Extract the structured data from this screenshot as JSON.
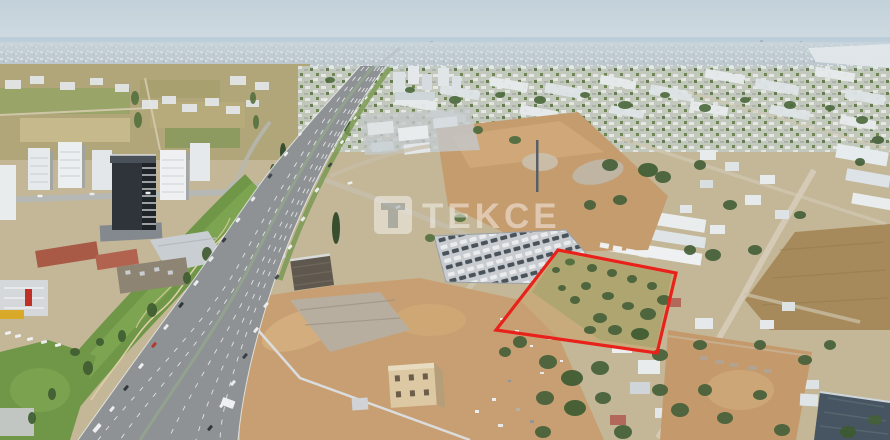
{
  "image": {
    "type": "aerial-drone-photo",
    "width": 890,
    "height": 440
  },
  "watermark": {
    "text": "TEKCE",
    "color": "#ffffff",
    "opacity": "0.45"
  },
  "plot_marker": {
    "shape": "quadrilateral",
    "points": "558,250 676,273 657,353 496,330",
    "stroke": "#e8221a",
    "stroke_width": "3.2"
  },
  "palette": {
    "sky_top": "#c2d1da",
    "sky_bottom": "#d3dce2",
    "sea": "#a9c2d3",
    "far_city": "#b6c1c7",
    "dirt": "#c59c6e",
    "dirt_light": "#d2ac7d",
    "asphalt": "#8e9294",
    "park_green": "#6f9747",
    "tree_green": "#45603a",
    "field_tan": "#b0a67a",
    "building_white": "#e9eced",
    "tower_dark": "#2e343a",
    "plot_red": "#e8221a"
  },
  "vehicles": [
    [
      97,
      428,
      10,
      4,
      "#eef0f1"
    ],
    [
      112,
      409,
      6,
      3,
      "#eceeef"
    ],
    [
      126,
      388,
      6,
      3,
      "#31373d"
    ],
    [
      141,
      366,
      6,
      3,
      "#f0f1f2"
    ],
    [
      154,
      345,
      6,
      3,
      "#b23a2c"
    ],
    [
      166,
      327,
      6,
      3,
      "#e8eaec"
    ],
    [
      181,
      305,
      6,
      3,
      "#2f353b"
    ],
    [
      196,
      283,
      6,
      3,
      "#eceeef"
    ],
    [
      211,
      259,
      6,
      3,
      "#e8eaec"
    ],
    [
      224,
      240,
      5,
      3,
      "#363c42"
    ],
    [
      238,
      220,
      5,
      3,
      "#eceeef"
    ],
    [
      253,
      199,
      5,
      3,
      "#e8eaec"
    ],
    [
      270,
      176,
      5,
      3,
      "#41474d"
    ],
    [
      286,
      154,
      5,
      2.5,
      "#eef0f1"
    ],
    [
      300,
      134,
      4,
      2.5,
      "#e8eaec"
    ],
    [
      313,
      117,
      4,
      2,
      "#d9dcde"
    ],
    [
      326,
      100,
      4,
      2,
      "#eceeef"
    ],
    [
      210,
      428,
      6,
      3,
      "#2f353b"
    ],
    [
      222,
      405,
      6,
      3,
      "#eef0f1"
    ],
    [
      233,
      383,
      6,
      3,
      "#e8eaec"
    ],
    [
      245,
      356,
      6,
      3,
      "#394047"
    ],
    [
      256,
      330,
      6,
      3,
      "#eceeef"
    ],
    [
      266,
      305,
      6,
      3,
      "#e9ebec"
    ],
    [
      277,
      277,
      5,
      3,
      "#454b51"
    ],
    [
      290,
      247,
      5,
      3,
      "#eef0f1"
    ],
    [
      303,
      219,
      5,
      3,
      "#e8eaec"
    ],
    [
      317,
      190,
      5,
      3,
      "#eceeef"
    ],
    [
      330,
      165,
      5,
      2.5,
      "#3d444a"
    ],
    [
      342,
      142,
      4,
      2.5,
      "#eef0f1"
    ],
    [
      355,
      118,
      4,
      2,
      "#e8eaec"
    ],
    [
      366,
      98,
      4,
      2,
      "#eceeef"
    ],
    [
      40,
      196,
      5,
      2.5,
      "#eef0f1",
      0
    ],
    [
      92,
      194,
      5,
      2.5,
      "#e8eaec",
      0
    ],
    [
      148,
      193,
      5,
      2.5,
      "#eceeef",
      0
    ],
    [
      350,
      183,
      5,
      2.5,
      "#eceeef",
      -15
    ],
    [
      398,
      207,
      5,
      2.5,
      "#e9ebec",
      -25
    ],
    [
      228,
      403,
      13,
      8,
      "#eef0f1",
      20
    ],
    [
      8,
      333,
      6,
      3,
      "#eef0f1",
      -15
    ],
    [
      18,
      336,
      6,
      3,
      "#eceeef",
      -15
    ],
    [
      30,
      339,
      6,
      3,
      "#eef0f1",
      -15
    ],
    [
      44,
      342,
      6,
      3,
      "#e8eaec",
      -15
    ],
    [
      58,
      345,
      6,
      3,
      "#eef0f1",
      -15
    ]
  ],
  "trees": [
    [
      336,
      228,
      4,
      16,
      "#2c4526"
    ],
    [
      347,
      126,
      3,
      9,
      "#35512e"
    ],
    [
      283,
      152,
      3,
      9,
      "#2c4829"
    ],
    [
      292,
      164,
      3,
      9,
      "#2c4829"
    ],
    [
      273,
      172,
      3,
      8,
      "#35512e"
    ],
    [
      330,
      80,
      5,
      3,
      "#4d6a3e"
    ],
    [
      360,
      95,
      6,
      4,
      "#4d6a3e"
    ],
    [
      410,
      90,
      5,
      3,
      "#4d6a3e"
    ],
    [
      455,
      100,
      6,
      4,
      "#4d6a3e"
    ],
    [
      500,
      95,
      5,
      3,
      "#4d6a3e"
    ],
    [
      540,
      100,
      6,
      4,
      "#4d6a3e"
    ],
    [
      585,
      95,
      5,
      3,
      "#4d6a3e"
    ],
    [
      625,
      105,
      7,
      4,
      "#4d6a3e"
    ],
    [
      665,
      95,
      5,
      3,
      "#4d6a3e"
    ],
    [
      705,
      108,
      6,
      4,
      "#4d6a3e"
    ],
    [
      745,
      100,
      5,
      3,
      "#4d6a3e"
    ],
    [
      790,
      105,
      6,
      4,
      "#4d6a3e"
    ],
    [
      830,
      108,
      5,
      3,
      "#4d6a3e"
    ],
    [
      862,
      120,
      6,
      4,
      "#4d6a3e"
    ],
    [
      610,
      165,
      8,
      6
    ],
    [
      648,
      170,
      10,
      7,
      "#3f5c33"
    ],
    [
      663,
      177,
      8,
      6
    ],
    [
      700,
      165,
      6,
      5
    ],
    [
      620,
      200,
      7,
      5
    ],
    [
      590,
      205,
      6,
      5
    ],
    [
      730,
      205,
      7,
      5
    ],
    [
      800,
      215,
      6,
      4
    ],
    [
      755,
      250,
      7,
      5
    ],
    [
      713,
      255,
      8,
      6
    ],
    [
      690,
      250,
      6,
      5
    ],
    [
      878,
      140,
      6,
      4
    ],
    [
      860,
      162,
      5,
      4
    ],
    [
      135,
      98,
      4,
      7,
      "#57713f"
    ],
    [
      138,
      120,
      4,
      8,
      "#57713f"
    ],
    [
      253,
      98,
      3,
      6,
      "#57713f"
    ],
    [
      256,
      122,
      3,
      7,
      "#57713f"
    ],
    [
      520,
      342,
      7,
      6
    ],
    [
      505,
      352,
      6,
      5
    ],
    [
      548,
      362,
      9,
      7
    ],
    [
      572,
      378,
      11,
      8,
      "#3d5a31"
    ],
    [
      600,
      368,
      9,
      7
    ],
    [
      545,
      398,
      9,
      7
    ],
    [
      575,
      408,
      11,
      8,
      "#3d5a31"
    ],
    [
      603,
      398,
      8,
      6
    ],
    [
      623,
      432,
      9,
      7
    ],
    [
      543,
      432,
      8,
      6
    ],
    [
      660,
      390,
      8,
      6
    ],
    [
      680,
      410,
      9,
      7
    ],
    [
      705,
      390,
      7,
      6
    ],
    [
      725,
      418,
      8,
      6
    ],
    [
      760,
      395,
      7,
      5
    ],
    [
      782,
      430,
      8,
      6
    ],
    [
      805,
      360,
      7,
      5
    ],
    [
      830,
      345,
      6,
      5
    ],
    [
      760,
      345,
      6,
      5
    ],
    [
      700,
      345,
      7,
      5
    ],
    [
      660,
      355,
      8,
      6
    ],
    [
      848,
      432,
      8,
      6,
      "#3d5a31"
    ],
    [
      875,
      420,
      7,
      5
    ],
    [
      570,
      262,
      5,
      3.5,
      "#4f6b3c"
    ],
    [
      592,
      268,
      5,
      4
    ],
    [
      612,
      273,
      5,
      4
    ],
    [
      632,
      279,
      5,
      4
    ],
    [
      652,
      286,
      5,
      4
    ],
    [
      664,
      300,
      7,
      5
    ],
    [
      648,
      314,
      8,
      6
    ],
    [
      628,
      306,
      6,
      4
    ],
    [
      608,
      296,
      6,
      4
    ],
    [
      586,
      286,
      5,
      4
    ],
    [
      600,
      318,
      7,
      5
    ],
    [
      575,
      300,
      5,
      4
    ],
    [
      640,
      334,
      9,
      6,
      "#3d5a31"
    ],
    [
      615,
      330,
      7,
      5
    ],
    [
      590,
      330,
      6,
      4
    ],
    [
      562,
      288,
      4,
      3
    ],
    [
      556,
      270,
      4,
      3
    ],
    [
      207,
      254,
      5,
      7,
      "#3f5c31"
    ],
    [
      187,
      278,
      4,
      6,
      "#3f5c31"
    ],
    [
      152,
      310,
      5,
      7,
      "#3f5c31"
    ],
    [
      122,
      336,
      4,
      6,
      "#3f5c31"
    ],
    [
      88,
      368,
      5,
      7,
      "#3f5c31"
    ],
    [
      52,
      394,
      4,
      6,
      "#3f5c31"
    ],
    [
      32,
      418,
      4,
      6,
      "#3f5c31"
    ],
    [
      75,
      352,
      5,
      4,
      "#3f5c31"
    ],
    [
      100,
      342,
      4,
      4,
      "#3f5c31"
    ],
    [
      478,
      130,
      5,
      4,
      "#4d6a3e"
    ],
    [
      515,
      140,
      6,
      4,
      "#4d6a3e"
    ],
    [
      460,
      218,
      6,
      4,
      "#55703f"
    ],
    [
      430,
      238,
      5,
      4,
      "#55703f"
    ]
  ]
}
